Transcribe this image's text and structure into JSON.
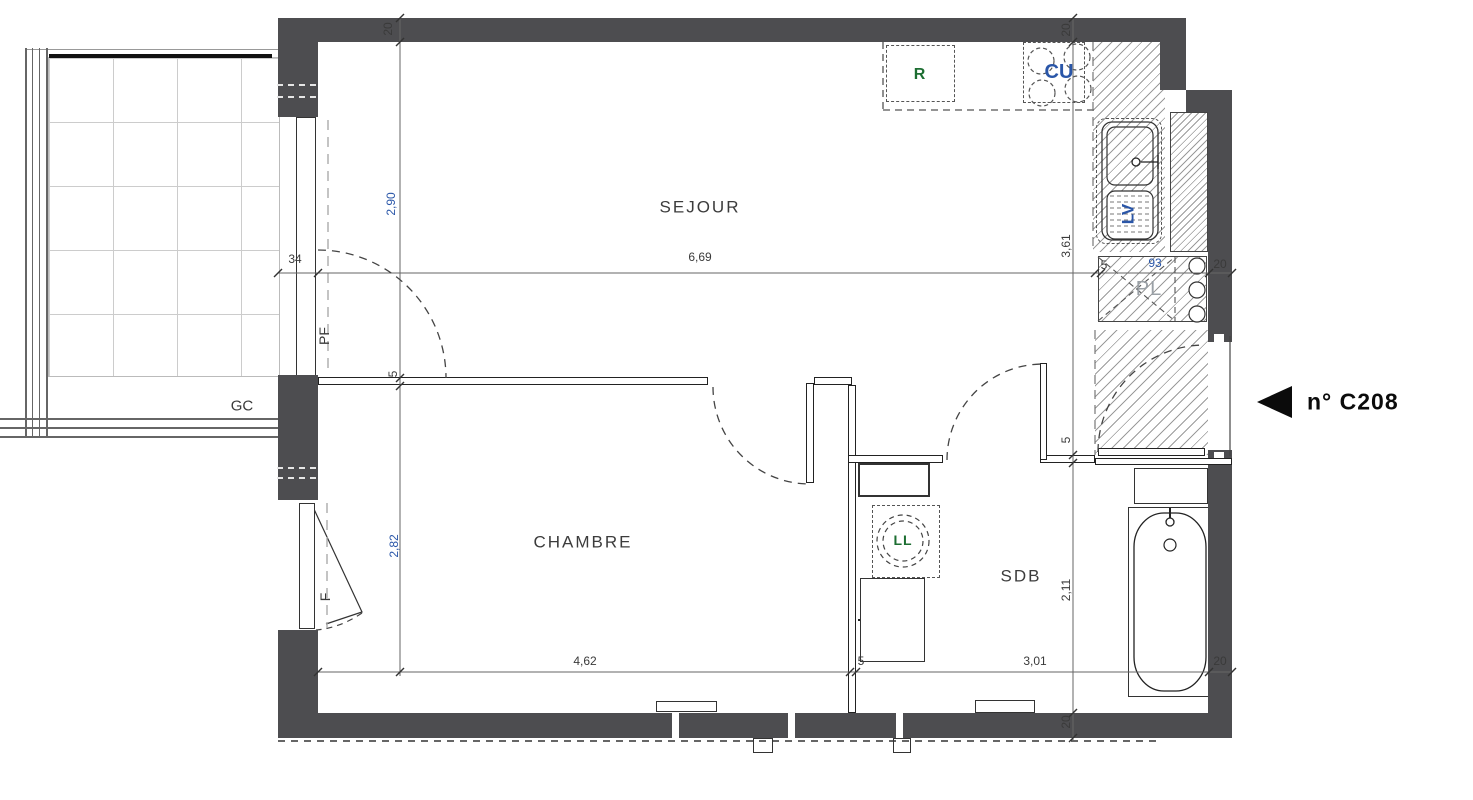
{
  "colors": {
    "wall": "#4d4d50",
    "ink": "#3a3a3a",
    "blue": "#2a56a8",
    "green": "#1d6e32",
    "gray_label": "#9aa0a6",
    "hatch": "#9b9b9b"
  },
  "unit": {
    "arrow_icon": "left-triangle",
    "label": "n° C208"
  },
  "rooms": [
    {
      "id": "sejour",
      "label": "SEJOUR"
    },
    {
      "id": "chambre",
      "label": "CHAMBRE"
    },
    {
      "id": "sdb",
      "label": "SDB"
    }
  ],
  "annotations": [
    {
      "id": "r",
      "label": "R"
    },
    {
      "id": "cu",
      "label": "CU"
    },
    {
      "id": "lv",
      "label": "LV"
    },
    {
      "id": "pl",
      "label": "PL"
    },
    {
      "id": "ll",
      "label": "LL"
    },
    {
      "id": "gc",
      "label": "GC"
    },
    {
      "id": "pf",
      "label": "PF"
    },
    {
      "id": "f",
      "label": "F"
    }
  ],
  "labels": {
    "sejour": "SEJOUR",
    "chambre": "CHAMBRE",
    "sdb": "SDB",
    "r": "R",
    "cu": "CU",
    "lv": "LV",
    "pl": "PL",
    "ll": "LL",
    "gc": "GC",
    "pf": "PF",
    "f": "F",
    "c208": "n° C208",
    "d_20_tl": "20",
    "d_290": "2,90",
    "d_34": "34",
    "d_669": "6,69",
    "d_5_sej": "5",
    "d_20_tr": "20",
    "d_361": "3,61",
    "d_5_pl": "5",
    "d_93": "93",
    "d_20_pl": "20",
    "d_282": "2,82",
    "d_462": "4,62",
    "d_5_sdb": "5",
    "d_301": "3,01",
    "d_211": "2,11",
    "d_20_br": "20",
    "d_20_bot": "20",
    "d_5_ent": "5"
  }
}
